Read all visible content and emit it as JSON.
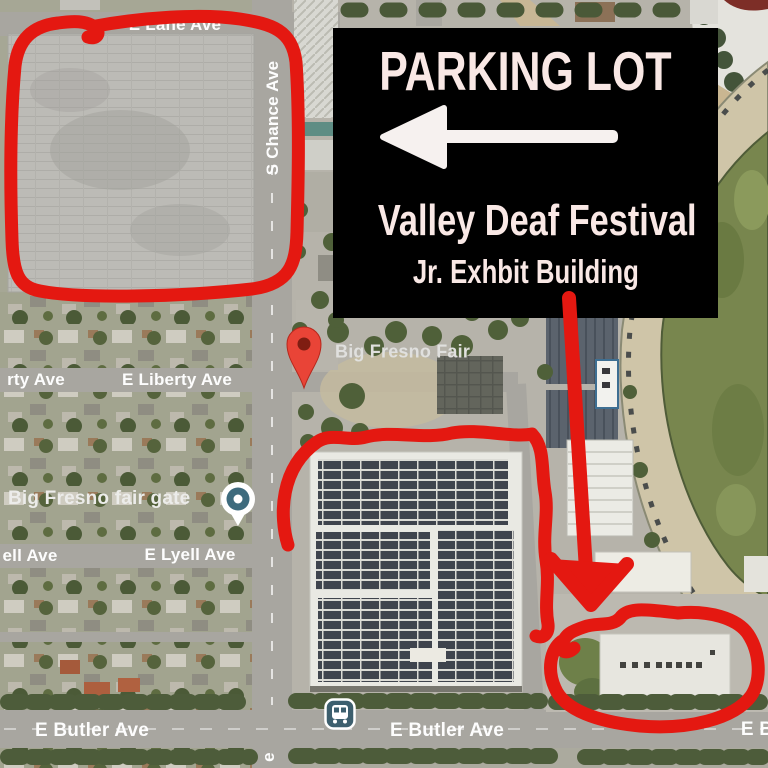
{
  "card": {
    "title": "PARKING LOT",
    "subtitle": "Valley Deaf Festival",
    "subtitle2": "Jr. Exhbit Building",
    "bg_color": "#000000",
    "text_color": "#f9e8e5",
    "arrow_icon": "arrow-left",
    "arrow_color": "#f6f1ef"
  },
  "map": {
    "style": "satellite",
    "poi": {
      "fair": {
        "text": "Big Fresno Fair",
        "marker": "red-pin"
      },
      "gate": {
        "text": "Big Fresno fair gate",
        "marker": "gate-circle"
      }
    },
    "streets": {
      "lane": "E Lane Ave",
      "chance": "S Chance Ave",
      "liberty_partial": "rty Ave",
      "liberty": "E Liberty Ave",
      "lyell_partial": "ell Ave",
      "lyell": "E Lyell Ave",
      "butler_west": "E Butler Ave",
      "butler_mid": "E Butler Ave",
      "butler_east_partial": "E B",
      "chance_south_partial": "e"
    },
    "transit": {
      "bus_stop": "bus-icon"
    },
    "annotation_color": "#e41811"
  }
}
